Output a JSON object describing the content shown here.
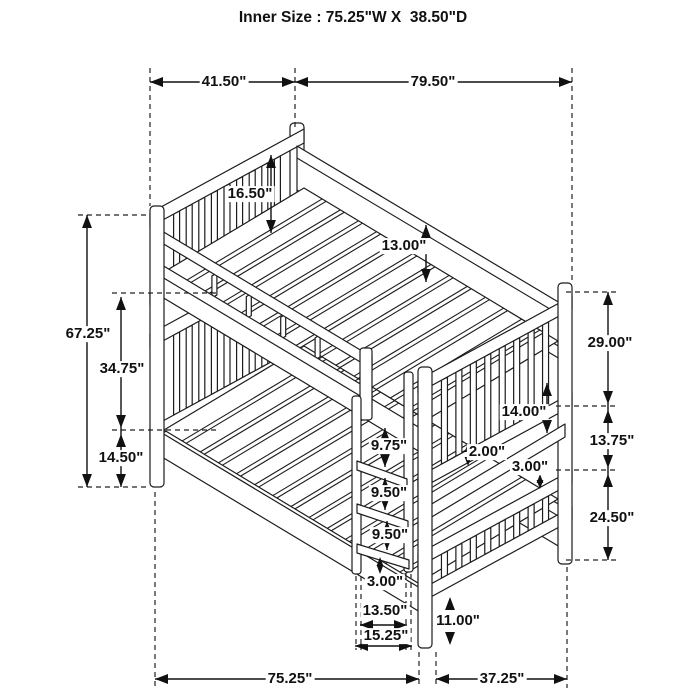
{
  "title": "Inner Size : 75.25\"W X  38.50\"D",
  "subject": "bunk-bed-dimension-diagram",
  "colors": {
    "line": "#1c1c1c",
    "dimension": "#111111",
    "background": "#ffffff"
  },
  "dims": [
    {
      "name": "top-left-width",
      "text": "41.50\""
    },
    {
      "name": "top-right-length",
      "text": "79.50\""
    },
    {
      "name": "overall-height",
      "text": "67.25\""
    },
    {
      "name": "left-upper-section",
      "text": "34.75\""
    },
    {
      "name": "left-lower-section",
      "text": "14.50\""
    },
    {
      "name": "headboard-height",
      "text": "16.50\""
    },
    {
      "name": "side-rail-height",
      "text": "13.00\""
    },
    {
      "name": "right-upper-section",
      "text": "29.00\""
    },
    {
      "name": "right-middle-gap",
      "text": "13.75\""
    },
    {
      "name": "right-lower-section",
      "text": "24.50\""
    },
    {
      "name": "bunk-clearance",
      "text": "14.00\""
    },
    {
      "name": "slat-thickness",
      "text": "2.00\""
    },
    {
      "name": "rail-thickness",
      "text": "3.00\""
    },
    {
      "name": "ladder-step-top",
      "text": "9.75\""
    },
    {
      "name": "ladder-step-mid",
      "text": "9.50\""
    },
    {
      "name": "ladder-step-lower",
      "text": "9.50\""
    },
    {
      "name": "ladder-bottom-gap",
      "text": "3.00\""
    },
    {
      "name": "ladder-inner-width",
      "text": "13.50\""
    },
    {
      "name": "ladder-outer-width",
      "text": "15.25\""
    },
    {
      "name": "floor-clearance",
      "text": "11.00\""
    },
    {
      "name": "bottom-length",
      "text": "75.25\""
    },
    {
      "name": "bottom-depth",
      "text": "37.25\""
    }
  ]
}
